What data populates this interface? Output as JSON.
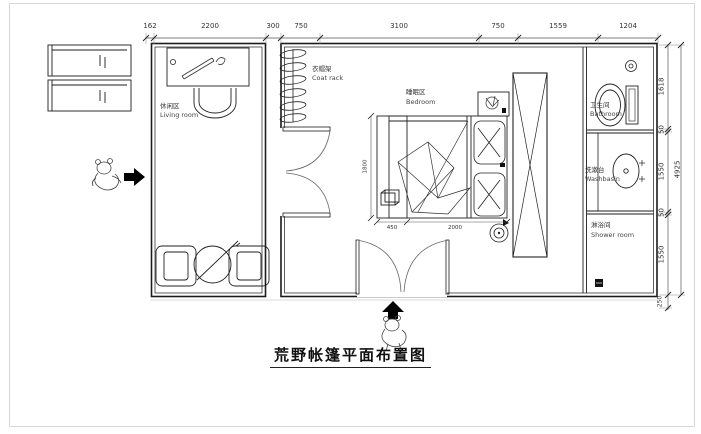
{
  "title": "荒野帐篷平面布置图",
  "rooms": {
    "living": {
      "zh": "休闲区",
      "en": "Living room"
    },
    "coat_rack": {
      "zh": "衣帽架",
      "en": "Coat rack"
    },
    "bedroom": {
      "zh": "睡眠区",
      "en": "Bedroom"
    },
    "bathroom": {
      "zh": "卫生间",
      "en": "Bathroom"
    },
    "washbasin": {
      "zh": "洗漱台",
      "en": "Washbasin"
    },
    "shower": {
      "zh": "淋浴间",
      "en": "Shower room"
    }
  },
  "dims": {
    "top": [
      "162",
      "2200",
      "300",
      "750",
      "3100",
      "750",
      "1559",
      "1204"
    ],
    "right": [
      "1618",
      "50",
      "1550",
      "50",
      "1550",
      "250"
    ],
    "right_overall": "4925",
    "bed_length": "1800",
    "bench_width": "450",
    "bed_width": "2000"
  },
  "colors": {
    "line": "#1c1c1c",
    "dim_line": "#555555",
    "light_line": "#cfcfcf",
    "text": "#333333"
  }
}
